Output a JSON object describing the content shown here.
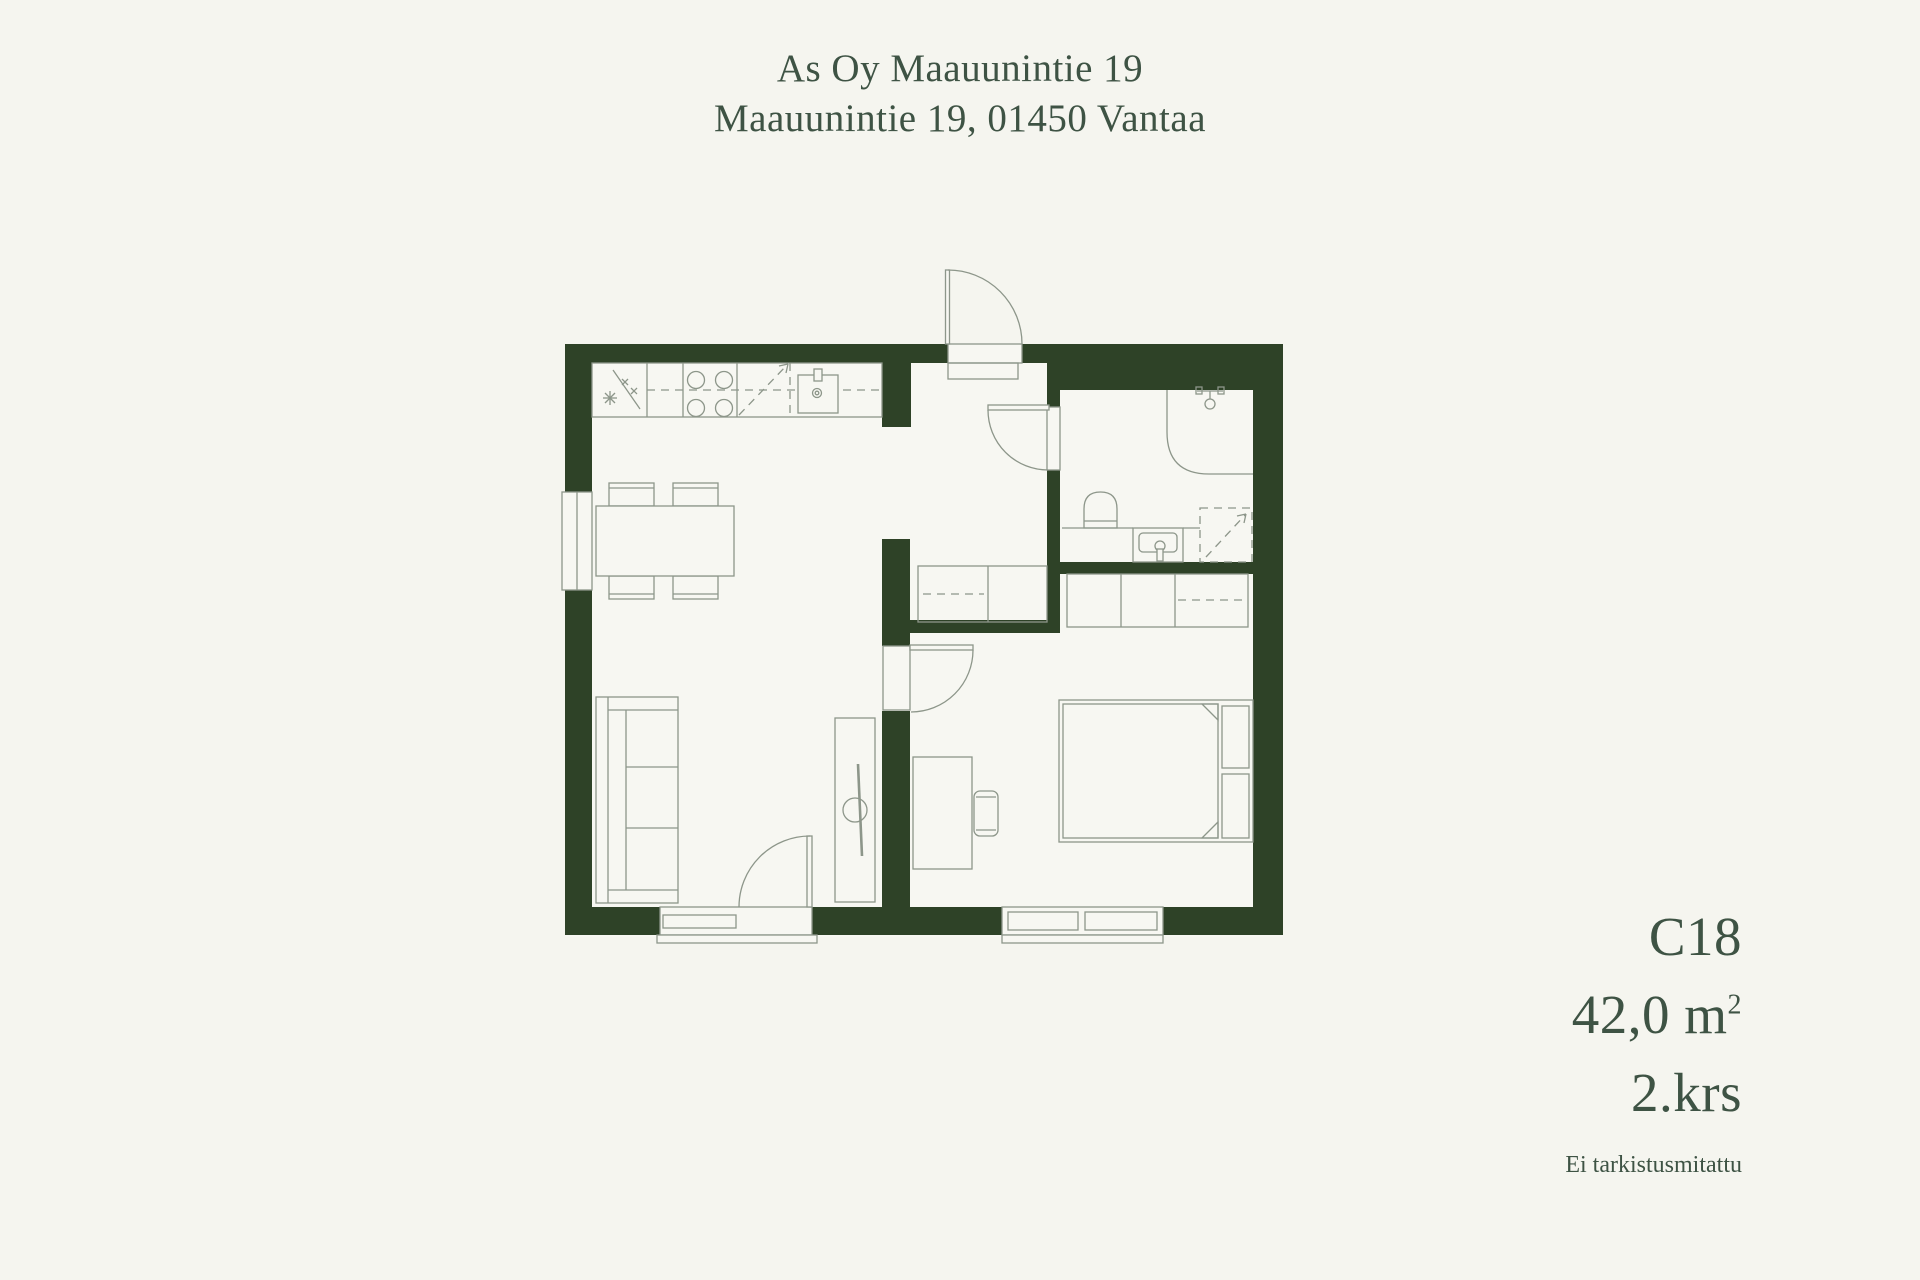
{
  "header": {
    "building": "As Oy Maauunintie 19",
    "address": "Maauunintie 19, 01450 Vantaa"
  },
  "unit_info": {
    "unit_id": "C18",
    "area": "42,0 m",
    "area_sup": "2",
    "floor": "2.krs",
    "note": "Ei tarkistusmitattu"
  },
  "colors": {
    "background": "#f5f5ef",
    "floor": "#f7f7f2",
    "wall": "#2e4227",
    "drawing_line": "#8d968a",
    "text": "#3e5344"
  }
}
